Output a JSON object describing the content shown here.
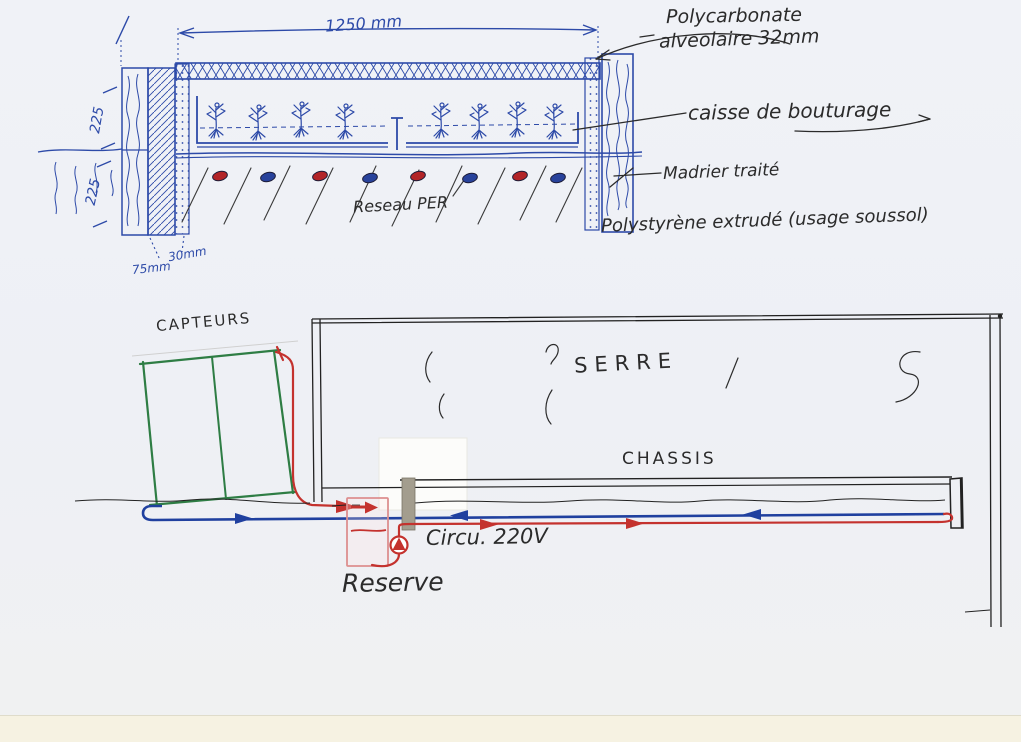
{
  "document": {
    "type": "hand-drawn scanned schematic",
    "language": "French",
    "subject": "Greenhouse cutting-box and solar heating circuit sketch"
  },
  "colors": {
    "paper": "#eff1f5",
    "scanner_edge_band": "#f6f2e2",
    "pen_blue": "#2d4aa8",
    "ink_black": "#2b2b2b",
    "pen_red": "#c4322e",
    "pen_green": "#2e7d44",
    "tank_pink": "#dd8f8f",
    "post_gray": "#a39d8e"
  },
  "cross_section": {
    "dim_width": "1250 mm",
    "dim_height_upper": "225",
    "dim_height_lower": "225",
    "dim_layer_thin": "30mm",
    "dim_layer_thick": "75mm",
    "label_cover_line1": "Polycarbonate",
    "label_cover_line2": "alveolaire 32mm",
    "label_box": "caisse de bouturage",
    "label_wood": "Madrier traité",
    "label_insulation": "Polystyrène extrudé (usage soussol)",
    "label_pipe_network": "Reseau PER",
    "pipe_dots": [
      "red",
      "blue",
      "red",
      "blue",
      "red",
      "blue",
      "red",
      "blue"
    ],
    "plant_count": 8
  },
  "system_diagram": {
    "label_collectors": "CAPTEURS",
    "label_greenhouse": "SERRE",
    "label_coldframe": "CHASSIS",
    "label_circulator": "Circu. 220V",
    "label_tank": "Reserve",
    "supply_pipe_color": "red",
    "return_pipe_color": "blue"
  }
}
